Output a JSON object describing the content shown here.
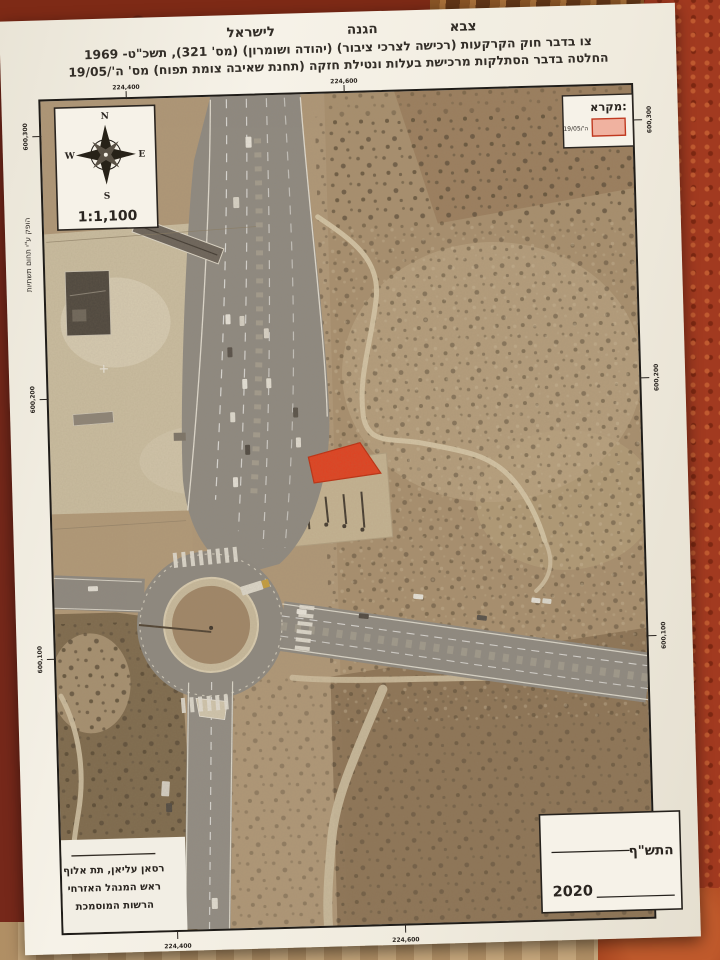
{
  "header": {
    "org_right": "צבא",
    "org_mid": "הגנה",
    "org_left": "לישראל",
    "order_line": "צו בדבר חוק הקרקעות (רכישה לצרכי ציבור) (יהודה ושומרון) (מס' 321), תשכ\"ט- 1969",
    "decision_line": "החלטה בדבר הסתלקות מרכישת בעלות ונטילת חזקה (תחנת שאיבה צומת תפוח) מס' ה'/19/05"
  },
  "map": {
    "scale_label": "1:1,100",
    "compass": {
      "n": "N",
      "e": "E",
      "s": "S",
      "w": "W"
    },
    "legend": {
      "title": "מקרא:",
      "item_label": "ה'/19/05"
    },
    "produced_by": "הופק ע\"י תחום תשתיות",
    "coordinates": {
      "top": [
        "224,400",
        "224,600"
      ],
      "bottom": [
        "224,400",
        "224,600"
      ],
      "left": [
        "600,300",
        "600,200",
        "600,100"
      ],
      "right": [
        "600,300",
        "600,200",
        "600,100"
      ]
    },
    "signature": {
      "line1": "רסאן עליאן, תת אלוף",
      "line2": "ראש המנהל האזרחי",
      "line3": "הרשות המוסמכת"
    },
    "date_box": {
      "hebrew_year": "התש\"ף",
      "gregorian_year": "2020"
    }
  },
  "colors": {
    "seizure_area": "#e6401f",
    "legend_swatch": "#f0b2a0",
    "paper": "#f2eee4",
    "terrain": "#b29a7b",
    "road": "#8f8b84"
  }
}
